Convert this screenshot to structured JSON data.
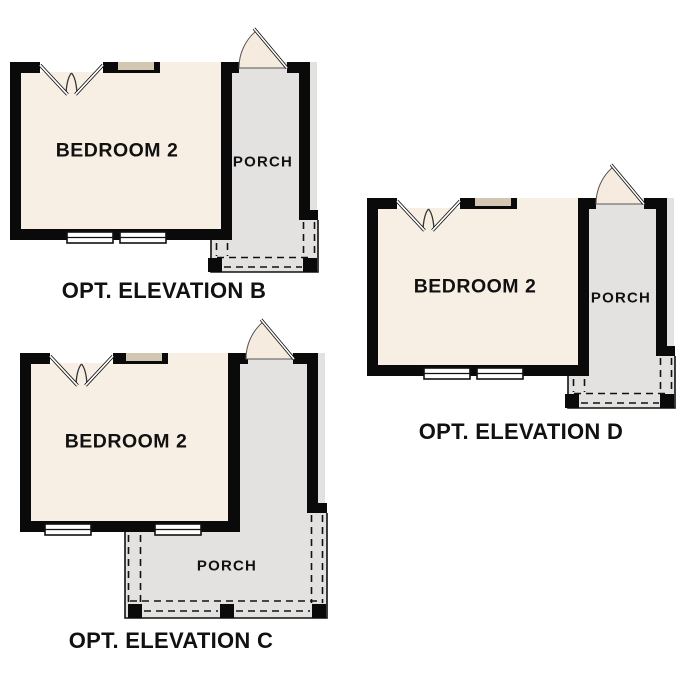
{
  "plans": {
    "b": {
      "title": "OPT. ELEVATION B",
      "room_label": "BEDROOM 2",
      "porch_label": "PORCH"
    },
    "c": {
      "title": "OPT. ELEVATION C",
      "room_label": "BEDROOM 2",
      "porch_label": "PORCH"
    },
    "d": {
      "title": "OPT. ELEVATION D",
      "room_label": "BEDROOM 2",
      "porch_label": "PORCH"
    }
  },
  "colors": {
    "wall": "#0a0a0a",
    "room_fill": "#f7efe3",
    "porch_fill": "#e3e2e0",
    "window_fill": "#d3c7b4",
    "door_fill": "#f5ecdf",
    "line": "#111111",
    "text": "#111111",
    "background": "#ffffff"
  }
}
